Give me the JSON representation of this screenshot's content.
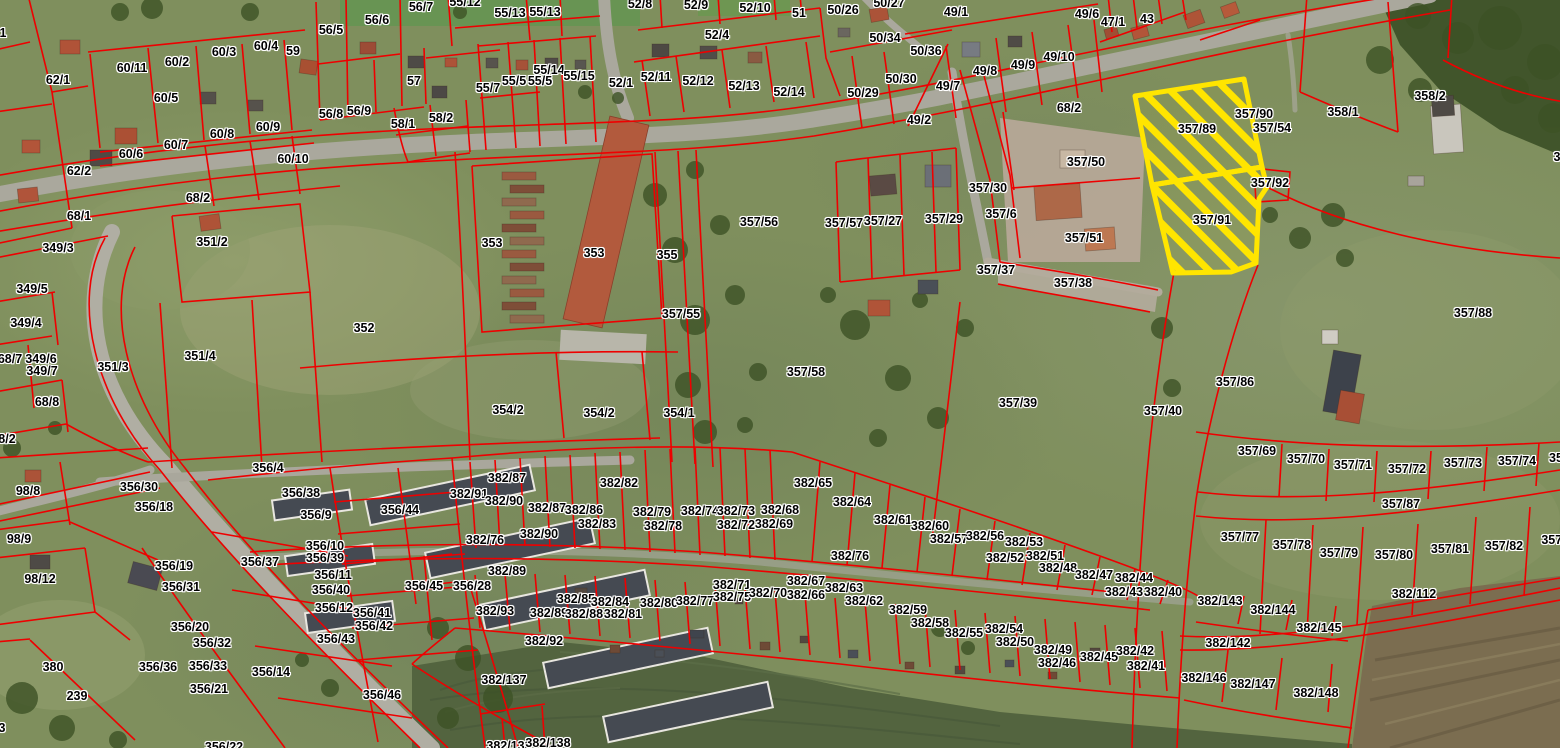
{
  "map": {
    "type": "cadastral-aerial-map",
    "colors": {
      "parcel_line": "#ee0000",
      "highlight": "#ffe500",
      "label_text": "#000000",
      "label_halo": "#ffffff"
    },
    "highlighted_parcels": [
      {
        "id": "357/89"
      },
      {
        "id": "357/91"
      }
    ],
    "labels": [
      {
        "t": "1",
        "x": 3,
        "y": 33
      },
      {
        "t": "62/1",
        "x": 58,
        "y": 80
      },
      {
        "t": "60/11",
        "x": 132,
        "y": 68
      },
      {
        "t": "60/2",
        "x": 177,
        "y": 62
      },
      {
        "t": "60/3",
        "x": 224,
        "y": 52
      },
      {
        "t": "60/4",
        "x": 266,
        "y": 46
      },
      {
        "t": "59",
        "x": 293,
        "y": 51
      },
      {
        "t": "56/5",
        "x": 331,
        "y": 30
      },
      {
        "t": "56/6",
        "x": 377,
        "y": 20
      },
      {
        "t": "56/7",
        "x": 421,
        "y": 7
      },
      {
        "t": "55/12",
        "x": 465,
        "y": 2
      },
      {
        "t": "55/13",
        "x": 510,
        "y": 13
      },
      {
        "t": "55/13",
        "x": 545,
        "y": 12
      },
      {
        "t": "52/8",
        "x": 640,
        "y": 4
      },
      {
        "t": "52/9",
        "x": 696,
        "y": 5
      },
      {
        "t": "52/10",
        "x": 755,
        "y": 8
      },
      {
        "t": "51",
        "x": 799,
        "y": 13
      },
      {
        "t": "50/26",
        "x": 843,
        "y": 10
      },
      {
        "t": "50/27",
        "x": 889,
        "y": 3
      },
      {
        "t": "49/1",
        "x": 956,
        "y": 12
      },
      {
        "t": "49/6",
        "x": 1087,
        "y": 14
      },
      {
        "t": "47/1",
        "x": 1113,
        "y": 22
      },
      {
        "t": "43",
        "x": 1147,
        "y": 19
      },
      {
        "t": "60/5",
        "x": 166,
        "y": 98
      },
      {
        "t": "56/8",
        "x": 331,
        "y": 114
      },
      {
        "t": "56/9",
        "x": 359,
        "y": 111
      },
      {
        "t": "60/8",
        "x": 222,
        "y": 134
      },
      {
        "t": "60/9",
        "x": 268,
        "y": 127
      },
      {
        "t": "58/1",
        "x": 403,
        "y": 124
      },
      {
        "t": "58/2",
        "x": 441,
        "y": 118
      },
      {
        "t": "57",
        "x": 414,
        "y": 81
      },
      {
        "t": "55/7",
        "x": 488,
        "y": 88
      },
      {
        "t": "55/5",
        "x": 514,
        "y": 81
      },
      {
        "t": "55/5",
        "x": 540,
        "y": 81
      },
      {
        "t": "55/14",
        "x": 549,
        "y": 70
      },
      {
        "t": "55/15",
        "x": 579,
        "y": 76
      },
      {
        "t": "52/1",
        "x": 621,
        "y": 83
      },
      {
        "t": "52/11",
        "x": 656,
        "y": 77
      },
      {
        "t": "52/12",
        "x": 698,
        "y": 81
      },
      {
        "t": "52/13",
        "x": 744,
        "y": 86
      },
      {
        "t": "52/14",
        "x": 789,
        "y": 92
      },
      {
        "t": "52/4",
        "x": 717,
        "y": 35
      },
      {
        "t": "50/34",
        "x": 885,
        "y": 38
      },
      {
        "t": "50/36",
        "x": 926,
        "y": 51
      },
      {
        "t": "50/30",
        "x": 901,
        "y": 79
      },
      {
        "t": "50/29",
        "x": 863,
        "y": 93
      },
      {
        "t": "49/7",
        "x": 948,
        "y": 86
      },
      {
        "t": "49/8",
        "x": 985,
        "y": 71
      },
      {
        "t": "49/9",
        "x": 1023,
        "y": 65
      },
      {
        "t": "49/10",
        "x": 1059,
        "y": 57
      },
      {
        "t": "49/2",
        "x": 919,
        "y": 120
      },
      {
        "t": "68/2",
        "x": 1069,
        "y": 108
      },
      {
        "t": "60/6",
        "x": 131,
        "y": 154
      },
      {
        "t": "60/7",
        "x": 176,
        "y": 145
      },
      {
        "t": "60/10",
        "x": 293,
        "y": 159
      },
      {
        "t": "62/2",
        "x": 79,
        "y": 171
      },
      {
        "t": "68/2",
        "x": 198,
        "y": 198
      },
      {
        "t": "68/1",
        "x": 79,
        "y": 216
      },
      {
        "t": "349/3",
        "x": 58,
        "y": 248
      },
      {
        "t": "351/2",
        "x": 212,
        "y": 242
      },
      {
        "t": "349/5",
        "x": 32,
        "y": 289
      },
      {
        "t": "349/4",
        "x": 26,
        "y": 323
      },
      {
        "t": "68/7",
        "x": 10,
        "y": 359
      },
      {
        "t": "349/6",
        "x": 41,
        "y": 359
      },
      {
        "t": "349/7",
        "x": 42,
        "y": 371
      },
      {
        "t": "68/8",
        "x": 47,
        "y": 402
      },
      {
        "t": "351/3",
        "x": 113,
        "y": 367
      },
      {
        "t": "351/4",
        "x": 200,
        "y": 356
      },
      {
        "t": "352",
        "x": 364,
        "y": 328
      },
      {
        "t": "353",
        "x": 492,
        "y": 243
      },
      {
        "t": "353",
        "x": 594,
        "y": 253
      },
      {
        "t": "355",
        "x": 667,
        "y": 255
      },
      {
        "t": "357/56",
        "x": 759,
        "y": 222
      },
      {
        "t": "357/55",
        "x": 681,
        "y": 314
      },
      {
        "t": "354/2",
        "x": 508,
        "y": 410
      },
      {
        "t": "354/2",
        "x": 599,
        "y": 413
      },
      {
        "t": "354/1",
        "x": 679,
        "y": 413
      },
      {
        "t": "357/58",
        "x": 806,
        "y": 372
      },
      {
        "t": "357/57",
        "x": 844,
        "y": 223
      },
      {
        "t": "357/27",
        "x": 883,
        "y": 221
      },
      {
        "t": "357/29",
        "x": 944,
        "y": 219
      },
      {
        "t": "357/30",
        "x": 988,
        "y": 188
      },
      {
        "t": "357/6",
        "x": 1001,
        "y": 214
      },
      {
        "t": "357/50",
        "x": 1086,
        "y": 162
      },
      {
        "t": "357/51",
        "x": 1084,
        "y": 238
      },
      {
        "t": "357/37",
        "x": 996,
        "y": 270
      },
      {
        "t": "357/38",
        "x": 1073,
        "y": 283
      },
      {
        "t": "357/39",
        "x": 1018,
        "y": 403
      },
      {
        "t": "357/40",
        "x": 1163,
        "y": 411
      },
      {
        "t": "357/89",
        "x": 1197,
        "y": 129
      },
      {
        "t": "357/90",
        "x": 1254,
        "y": 114
      },
      {
        "t": "357/54",
        "x": 1272,
        "y": 128
      },
      {
        "t": "357/92",
        "x": 1270,
        "y": 183
      },
      {
        "t": "357/91",
        "x": 1212,
        "y": 220
      },
      {
        "t": "358/1",
        "x": 1343,
        "y": 112
      },
      {
        "t": "358/2",
        "x": 1430,
        "y": 96
      },
      {
        "t": "3",
        "x": 1557,
        "y": 157
      },
      {
        "t": "357/88",
        "x": 1473,
        "y": 313
      },
      {
        "t": "357/86",
        "x": 1235,
        "y": 382
      },
      {
        "t": "357/69",
        "x": 1257,
        "y": 451
      },
      {
        "t": "357/70",
        "x": 1306,
        "y": 459
      },
      {
        "t": "357/71",
        "x": 1353,
        "y": 465
      },
      {
        "t": "357/72",
        "x": 1407,
        "y": 469
      },
      {
        "t": "357/73",
        "x": 1463,
        "y": 463
      },
      {
        "t": "357/74",
        "x": 1517,
        "y": 461
      },
      {
        "t": "35",
        "x": 1556,
        "y": 458
      },
      {
        "t": "357/87",
        "x": 1401,
        "y": 504
      },
      {
        "t": "357/77",
        "x": 1240,
        "y": 537
      },
      {
        "t": "357/78",
        "x": 1292,
        "y": 545
      },
      {
        "t": "357/79",
        "x": 1339,
        "y": 553
      },
      {
        "t": "357/80",
        "x": 1394,
        "y": 555
      },
      {
        "t": "357/81",
        "x": 1450,
        "y": 549
      },
      {
        "t": "357/82",
        "x": 1504,
        "y": 546
      },
      {
        "t": "357/8",
        "x": 1557,
        "y": 540
      },
      {
        "t": "382/112",
        "x": 1414,
        "y": 594
      },
      {
        "t": "382/143",
        "x": 1220,
        "y": 601
      },
      {
        "t": "382/144",
        "x": 1273,
        "y": 610
      },
      {
        "t": "382/145",
        "x": 1319,
        "y": 628
      },
      {
        "t": "382/142",
        "x": 1228,
        "y": 643
      },
      {
        "t": "382/146",
        "x": 1204,
        "y": 678
      },
      {
        "t": "382/147",
        "x": 1253,
        "y": 684
      },
      {
        "t": "382/148",
        "x": 1316,
        "y": 693
      },
      {
        "t": "8/2",
        "x": 7,
        "y": 439
      },
      {
        "t": "98/8",
        "x": 28,
        "y": 491
      },
      {
        "t": "98/9",
        "x": 19,
        "y": 539
      },
      {
        "t": "98/12",
        "x": 40,
        "y": 579
      },
      {
        "t": "356/4",
        "x": 268,
        "y": 468
      },
      {
        "t": "356/30",
        "x": 139,
        "y": 487
      },
      {
        "t": "356/18",
        "x": 154,
        "y": 507
      },
      {
        "t": "356/38",
        "x": 301,
        "y": 493
      },
      {
        "t": "356/9",
        "x": 316,
        "y": 515
      },
      {
        "t": "356/44",
        "x": 400,
        "y": 510
      },
      {
        "t": "356/37",
        "x": 260,
        "y": 562
      },
      {
        "t": "356/10",
        "x": 325,
        "y": 546
      },
      {
        "t": "356/39",
        "x": 325,
        "y": 558
      },
      {
        "t": "356/19",
        "x": 174,
        "y": 566
      },
      {
        "t": "356/31",
        "x": 181,
        "y": 587
      },
      {
        "t": "356/11",
        "x": 333,
        "y": 575
      },
      {
        "t": "356/40",
        "x": 331,
        "y": 590
      },
      {
        "t": "356/12",
        "x": 334,
        "y": 608
      },
      {
        "t": "356/41",
        "x": 372,
        "y": 613
      },
      {
        "t": "356/42",
        "x": 374,
        "y": 626
      },
      {
        "t": "356/43",
        "x": 336,
        "y": 639
      },
      {
        "t": "356/20",
        "x": 190,
        "y": 627
      },
      {
        "t": "356/32",
        "x": 212,
        "y": 643
      },
      {
        "t": "356/36",
        "x": 158,
        "y": 667
      },
      {
        "t": "356/33",
        "x": 208,
        "y": 666
      },
      {
        "t": "356/14",
        "x": 271,
        "y": 672
      },
      {
        "t": "356/21",
        "x": 209,
        "y": 689
      },
      {
        "t": "356/46",
        "x": 382,
        "y": 695
      },
      {
        "t": "380",
        "x": 53,
        "y": 667
      },
      {
        "t": "239",
        "x": 77,
        "y": 696
      },
      {
        "t": "356/22",
        "x": 224,
        "y": 747
      },
      {
        "t": "3",
        "x": 2,
        "y": 728
      },
      {
        "t": "356/45",
        "x": 424,
        "y": 586
      },
      {
        "t": "356/28",
        "x": 472,
        "y": 586
      },
      {
        "t": "382/87",
        "x": 507,
        "y": 478
      },
      {
        "t": "382/82",
        "x": 619,
        "y": 483
      },
      {
        "t": "382/91",
        "x": 469,
        "y": 494
      },
      {
        "t": "382/90",
        "x": 504,
        "y": 501
      },
      {
        "t": "382/87",
        "x": 547,
        "y": 508
      },
      {
        "t": "382/86",
        "x": 584,
        "y": 510
      },
      {
        "t": "382/79",
        "x": 652,
        "y": 512
      },
      {
        "t": "382/74",
        "x": 700,
        "y": 511
      },
      {
        "t": "382/73",
        "x": 736,
        "y": 511
      },
      {
        "t": "382/68",
        "x": 780,
        "y": 510
      },
      {
        "t": "382/83",
        "x": 597,
        "y": 524
      },
      {
        "t": "382/78",
        "x": 663,
        "y": 526
      },
      {
        "t": "382/72",
        "x": 736,
        "y": 525
      },
      {
        "t": "382/69",
        "x": 774,
        "y": 524
      },
      {
        "t": "382/76",
        "x": 485,
        "y": 540
      },
      {
        "t": "382/90",
        "x": 539,
        "y": 534
      },
      {
        "t": "382/65",
        "x": 813,
        "y": 483
      },
      {
        "t": "382/64",
        "x": 852,
        "y": 502
      },
      {
        "t": "382/61",
        "x": 893,
        "y": 520
      },
      {
        "t": "382/60",
        "x": 930,
        "y": 526
      },
      {
        "t": "382/57",
        "x": 949,
        "y": 539
      },
      {
        "t": "382/56",
        "x": 985,
        "y": 536
      },
      {
        "t": "382/53",
        "x": 1024,
        "y": 542
      },
      {
        "t": "382/76",
        "x": 850,
        "y": 556
      },
      {
        "t": "382/52",
        "x": 1005,
        "y": 558
      },
      {
        "t": "382/51",
        "x": 1045,
        "y": 556
      },
      {
        "t": "382/48",
        "x": 1058,
        "y": 568
      },
      {
        "t": "382/47",
        "x": 1094,
        "y": 575
      },
      {
        "t": "382/44",
        "x": 1134,
        "y": 578
      },
      {
        "t": "382/43",
        "x": 1124,
        "y": 592
      },
      {
        "t": "382/40",
        "x": 1163,
        "y": 592
      },
      {
        "t": "382/67",
        "x": 806,
        "y": 581
      },
      {
        "t": "382/66",
        "x": 806,
        "y": 595
      },
      {
        "t": "382/63",
        "x": 844,
        "y": 588
      },
      {
        "t": "382/62",
        "x": 864,
        "y": 601
      },
      {
        "t": "382/59",
        "x": 908,
        "y": 610
      },
      {
        "t": "382/71",
        "x": 732,
        "y": 585
      },
      {
        "t": "382/89",
        "x": 507,
        "y": 571
      },
      {
        "t": "382/85",
        "x": 576,
        "y": 599
      },
      {
        "t": "382/84",
        "x": 610,
        "y": 602
      },
      {
        "t": "382/80",
        "x": 659,
        "y": 603
      },
      {
        "t": "382/77",
        "x": 695,
        "y": 601
      },
      {
        "t": "382/75",
        "x": 732,
        "y": 597
      },
      {
        "t": "382/70",
        "x": 768,
        "y": 593
      },
      {
        "t": "382/93",
        "x": 495,
        "y": 611
      },
      {
        "t": "382/89",
        "x": 549,
        "y": 613
      },
      {
        "t": "382/88",
        "x": 584,
        "y": 614
      },
      {
        "t": "382/81",
        "x": 623,
        "y": 614
      },
      {
        "t": "382/92",
        "x": 544,
        "y": 641
      },
      {
        "t": "382/137",
        "x": 504,
        "y": 680
      },
      {
        "t": "382/138",
        "x": 509,
        "y": 746
      },
      {
        "t": "382/138",
        "x": 548,
        "y": 743
      },
      {
        "t": "382/58",
        "x": 930,
        "y": 623
      },
      {
        "t": "382/55",
        "x": 964,
        "y": 633
      },
      {
        "t": "382/54",
        "x": 1004,
        "y": 629
      },
      {
        "t": "382/50",
        "x": 1015,
        "y": 642
      },
      {
        "t": "382/49",
        "x": 1053,
        "y": 650
      },
      {
        "t": "382/46",
        "x": 1057,
        "y": 663
      },
      {
        "t": "382/45",
        "x": 1099,
        "y": 657
      },
      {
        "t": "382/42",
        "x": 1135,
        "y": 651
      },
      {
        "t": "382/41",
        "x": 1146,
        "y": 666
      }
    ]
  }
}
